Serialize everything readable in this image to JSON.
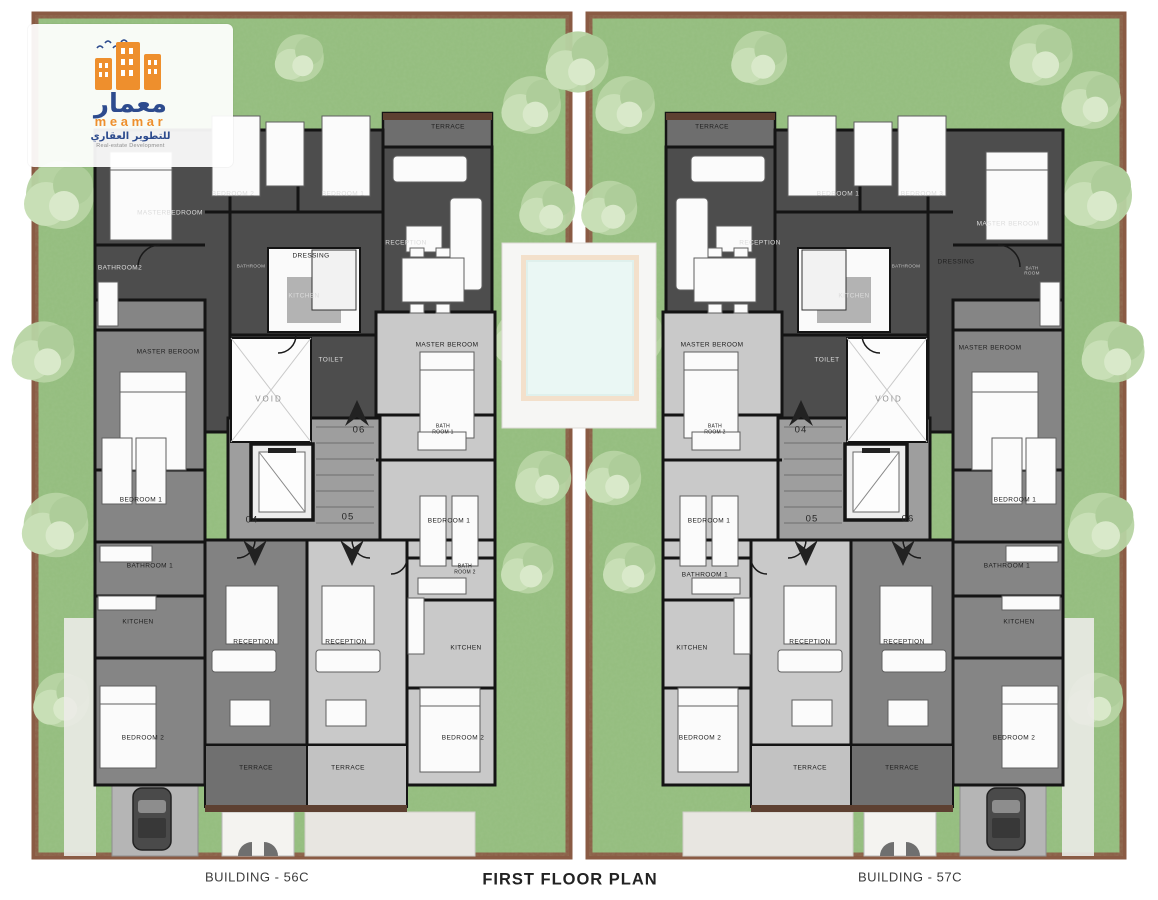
{
  "logo": {
    "arabic_name": "معمار",
    "brand": "meamar",
    "arabic_tagline": "للتطوير العقاري",
    "tagline": "Real-estate Development"
  },
  "captions": {
    "left": "BUILDING - 56C",
    "center": "FIRST FLOOR PLAN",
    "right": "BUILDING - 57C"
  },
  "colors": {
    "garden": "#94bd7e",
    "plot_frame": "#8a5b44",
    "wall_dark_room": "#4d4d4d",
    "medium_room": "#858585",
    "light_room": "#c9c9c9",
    "stair_core": "#9e9e9e",
    "pool_water": "#eaf7f4",
    "pool_edge": "#f3e0cb",
    "terrace_brown": "#5d4031",
    "logo_orange": "#ee8f2d",
    "logo_blue": "#2d4b8e"
  },
  "plan_labels": [
    {
      "b": "56C",
      "t": "MASTERBEDROOM",
      "x": 170,
      "y": 213,
      "k": "lt"
    },
    {
      "b": "56C",
      "t": "BEDROOM 2",
      "x": 233,
      "y": 194,
      "k": "lt"
    },
    {
      "b": "56C",
      "t": "BEDROOM 1",
      "x": 343,
      "y": 194,
      "k": "lt"
    },
    {
      "b": "56C",
      "t": "TERRACE",
      "x": 448,
      "y": 127,
      "k": "dk"
    },
    {
      "b": "56C",
      "t": "RECEPTION",
      "x": 406,
      "y": 243,
      "k": "lt"
    },
    {
      "b": "56C",
      "t": "DRESSING",
      "x": 311,
      "y": 256,
      "k": "dk"
    },
    {
      "b": "56C",
      "t": "BATHROOM",
      "x": 251,
      "y": 266,
      "k": "faint-lt"
    },
    {
      "b": "56C",
      "t": "KITCHEN",
      "x": 304,
      "y": 296,
      "k": "lt"
    },
    {
      "b": "56C",
      "t": "BATHROOM2",
      "x": 120,
      "y": 268,
      "k": "lt"
    },
    {
      "b": "56C",
      "t": "MASTER BEROOM",
      "x": 168,
      "y": 352,
      "k": "dk"
    },
    {
      "b": "56C",
      "t": "TOILET",
      "x": 331,
      "y": 360,
      "k": "lt"
    },
    {
      "b": "56C",
      "t": "VOID",
      "x": 269,
      "y": 399,
      "k": "faint"
    },
    {
      "b": "56C",
      "t": "06",
      "x": 359,
      "y": 431,
      "k": "unit"
    },
    {
      "b": "56C",
      "t": "MASTER BEROOM",
      "x": 447,
      "y": 345,
      "k": "dk"
    },
    {
      "b": "56C",
      "t": "BATH\nROOM 1",
      "x": 443,
      "y": 430,
      "k": "dk2"
    },
    {
      "b": "56C",
      "t": "BEDROOM 1",
      "x": 449,
      "y": 521,
      "k": "dk"
    },
    {
      "b": "56C",
      "t": "04",
      "x": 252,
      "y": 521,
      "k": "unit"
    },
    {
      "b": "56C",
      "t": "05",
      "x": 348,
      "y": 518,
      "k": "unit"
    },
    {
      "b": "56C",
      "t": "BATH\nROOM 2",
      "x": 465,
      "y": 570,
      "k": "dk2"
    },
    {
      "b": "56C",
      "t": "BEDROOM 1",
      "x": 141,
      "y": 500,
      "k": "dk"
    },
    {
      "b": "56C",
      "t": "BATHROOM 1",
      "x": 150,
      "y": 566,
      "k": "dk"
    },
    {
      "b": "56C",
      "t": "KITCHEN",
      "x": 138,
      "y": 622,
      "k": "dk"
    },
    {
      "b": "56C",
      "t": "KITCHEN",
      "x": 466,
      "y": 648,
      "k": "dk"
    },
    {
      "b": "56C",
      "t": "RECEPTION",
      "x": 254,
      "y": 642,
      "k": "dk"
    },
    {
      "b": "56C",
      "t": "RECEPTION",
      "x": 346,
      "y": 642,
      "k": "dk"
    },
    {
      "b": "56C",
      "t": "BEDROOM 2",
      "x": 143,
      "y": 738,
      "k": "dk"
    },
    {
      "b": "56C",
      "t": "BEDROOM 2",
      "x": 463,
      "y": 738,
      "k": "dk"
    },
    {
      "b": "56C",
      "t": "TERRACE",
      "x": 256,
      "y": 768,
      "k": "dk"
    },
    {
      "b": "56C",
      "t": "TERRACE",
      "x": 348,
      "y": 768,
      "k": "dk"
    },
    {
      "b": "57C",
      "t": "TERRACE",
      "x": 712,
      "y": 127,
      "k": "dk"
    },
    {
      "b": "57C",
      "t": "RECEPTION",
      "x": 760,
      "y": 243,
      "k": "lt"
    },
    {
      "b": "57C",
      "t": "BEDROOM 1",
      "x": 838,
      "y": 194,
      "k": "lt"
    },
    {
      "b": "57C",
      "t": "BEDROOM 3",
      "x": 922,
      "y": 194,
      "k": "lt"
    },
    {
      "b": "57C",
      "t": "MASTER BEROOM",
      "x": 1008,
      "y": 224,
      "k": "lt"
    },
    {
      "b": "57C",
      "t": "DRESSING",
      "x": 956,
      "y": 262,
      "k": "dk"
    },
    {
      "b": "57C",
      "t": "BATH\nROOM",
      "x": 1032,
      "y": 271,
      "k": "faint-lt"
    },
    {
      "b": "57C",
      "t": "BATHROOM",
      "x": 906,
      "y": 266,
      "k": "faint-lt"
    },
    {
      "b": "57C",
      "t": "KITCHEN",
      "x": 854,
      "y": 296,
      "k": "lt"
    },
    {
      "b": "57C",
      "t": "MASTER BEROOM",
      "x": 712,
      "y": 345,
      "k": "dk"
    },
    {
      "b": "57C",
      "t": "TOILET",
      "x": 827,
      "y": 360,
      "k": "lt"
    },
    {
      "b": "57C",
      "t": "VOID",
      "x": 889,
      "y": 399,
      "k": "faint"
    },
    {
      "b": "57C",
      "t": "04",
      "x": 801,
      "y": 431,
      "k": "unit"
    },
    {
      "b": "57C",
      "t": "BATH\nROOM 2",
      "x": 715,
      "y": 430,
      "k": "dk2"
    },
    {
      "b": "57C",
      "t": "BEDROOM 1",
      "x": 709,
      "y": 521,
      "k": "dk"
    },
    {
      "b": "57C",
      "t": "05",
      "x": 812,
      "y": 520,
      "k": "unit"
    },
    {
      "b": "57C",
      "t": "06",
      "x": 908,
      "y": 520,
      "k": "unit"
    },
    {
      "b": "57C",
      "t": "BATHROOM 1",
      "x": 705,
      "y": 575,
      "k": "dk"
    },
    {
      "b": "57C",
      "t": "KITCHEN",
      "x": 692,
      "y": 648,
      "k": "dk"
    },
    {
      "b": "57C",
      "t": "MASTER BEROOM",
      "x": 990,
      "y": 348,
      "k": "dk"
    },
    {
      "b": "57C",
      "t": "BEDROOM 1",
      "x": 1015,
      "y": 500,
      "k": "dk"
    },
    {
      "b": "57C",
      "t": "BATHROOM 1",
      "x": 1007,
      "y": 566,
      "k": "dk"
    },
    {
      "b": "57C",
      "t": "KITCHEN",
      "x": 1019,
      "y": 622,
      "k": "dk"
    },
    {
      "b": "57C",
      "t": "RECEPTION",
      "x": 810,
      "y": 642,
      "k": "dk"
    },
    {
      "b": "57C",
      "t": "RECEPTION",
      "x": 904,
      "y": 642,
      "k": "dk"
    },
    {
      "b": "57C",
      "t": "BEDROOM 2",
      "x": 700,
      "y": 738,
      "k": "dk"
    },
    {
      "b": "57C",
      "t": "BEDROOM 2",
      "x": 1014,
      "y": 738,
      "k": "dk"
    },
    {
      "b": "57C",
      "t": "TERRACE",
      "x": 810,
      "y": 768,
      "k": "dk"
    },
    {
      "b": "57C",
      "t": "TERRACE",
      "x": 902,
      "y": 768,
      "k": "dk"
    }
  ]
}
